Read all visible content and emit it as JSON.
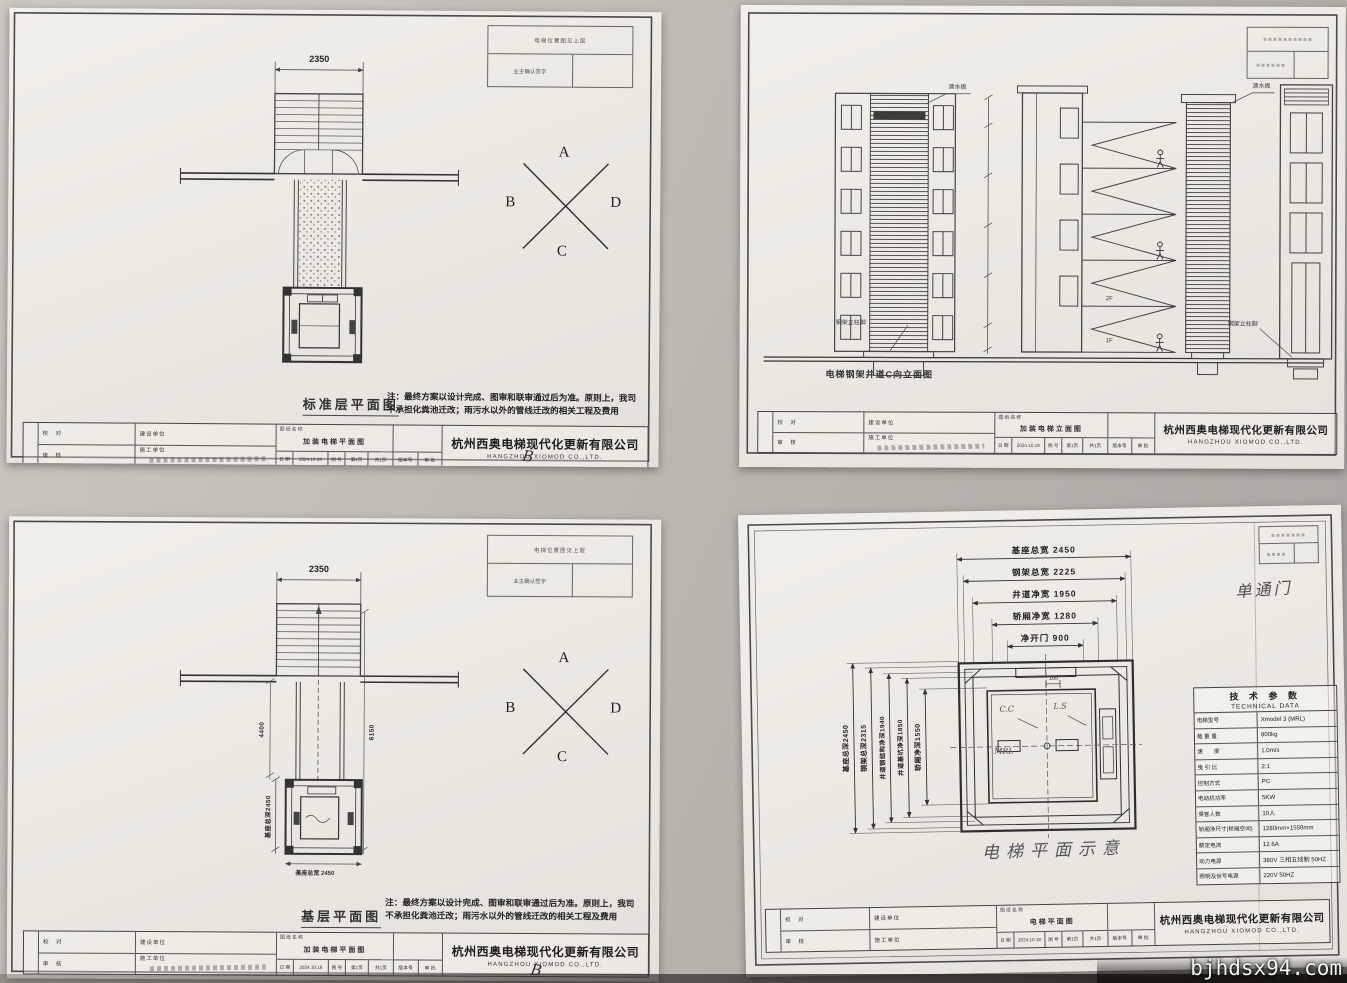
{
  "watermark": "bjhdsx94.com",
  "shared": {
    "company_cn": "杭州西奥电梯现代化更新有限公司",
    "company_en": "HANGZHOU XIOMOD CO.,LTD.",
    "note_line1": "注：最终方案以设计完成、图审和联审通过后为准。原则上，我司",
    "note_line2": "不承担化粪池迁改；雨污水以外的管线迁改的相关工程及费用",
    "corner_table": {
      "row1": "电梯位置图见上层",
      "row2": "业主确认签字"
    },
    "titleblock": {
      "check_label": "校 对",
      "review_label": "审 核",
      "owner_label": "建设单位",
      "builder_label": "施工单位",
      "name_label": "图纸名称",
      "date_label": "日 期",
      "date_value": "2024.10.18",
      "no_label": "图 号",
      "page_label": "第1页",
      "pages_label": "共1页",
      "version_label": "版本号",
      "approve_label": "审 批"
    }
  },
  "sheet_tl": {
    "caption": "标准层平面图",
    "drawing_name": "加装电梯平面图",
    "dim_top": "2350",
    "dir_a": "A",
    "dir_b": "B",
    "dir_c": "C",
    "dir_d": "D",
    "stamp": "B"
  },
  "sheet_tr": {
    "caption": "电梯钢架井道C向立面图",
    "drawing_name": "加装电梯立面图",
    "label_drip_left": "滴水板",
    "label_drip_right": "滴水板",
    "label_foot_left": "钢架立柱脚",
    "label_foot_right": "钢架立柱脚",
    "floor_2f": "2F",
    "floor_1f": "1F"
  },
  "sheet_bl": {
    "caption": "基层平面图",
    "drawing_name": "加装电梯平面图",
    "dim_top": "2350",
    "dim_v_left": "4400",
    "dim_v_right": "6150",
    "dim_shaft_w": "基座总宽 2450",
    "dim_shaft_d": "基座总深2450",
    "dir_a": "A",
    "dir_b": "B",
    "dir_c": "C",
    "dir_d": "D",
    "stamp": "B"
  },
  "sheet_br": {
    "handwritten_door_type": "单通门",
    "handwritten_caption": "电梯平面示意",
    "plan_label_gap": "100",
    "plan_label_cc": "C.C",
    "plan_label_ls": "L.S",
    "plan_label_mrl": "MRL",
    "dims_h": [
      "基座总宽 2450",
      "钢架总宽 2225",
      "井道净宽 1950",
      "轿厢净宽 1280",
      "净开门 900"
    ],
    "dims_v": [
      "基座总深2450",
      "钢架总深2315",
      "井道钢结构净深1940",
      "井道基坑净深1850",
      "轿厢净深1550"
    ],
    "drawing_name": "电梯平面图",
    "tech": {
      "title_cn": "技 术 参 数",
      "title_en": "TECHNICAL DATA",
      "rows": [
        {
          "l": "电梯型号",
          "v": "Xmodel 3 (MRL)"
        },
        {
          "l": "载 重 量",
          "v": "800kg"
        },
        {
          "l": "速　　度",
          "v": "1.0m/s"
        },
        {
          "l": "曳 引 比",
          "v": "2:1"
        },
        {
          "l": "控制方式",
          "v": "PC"
        },
        {
          "l": "电动机功率",
          "v": "5KW"
        },
        {
          "l": "乘客人数",
          "v": "10人"
        },
        {
          "l": "轿厢净尺寸(轿厢空间)",
          "v": "1280mm×1550mm"
        },
        {
          "l": "额定电流",
          "v": "12.6A"
        },
        {
          "l": "动力电源",
          "v": "380V 三相五线制 50HZ"
        },
        {
          "l": "照明及信号电源",
          "v": "220V 50HZ"
        }
      ]
    }
  }
}
